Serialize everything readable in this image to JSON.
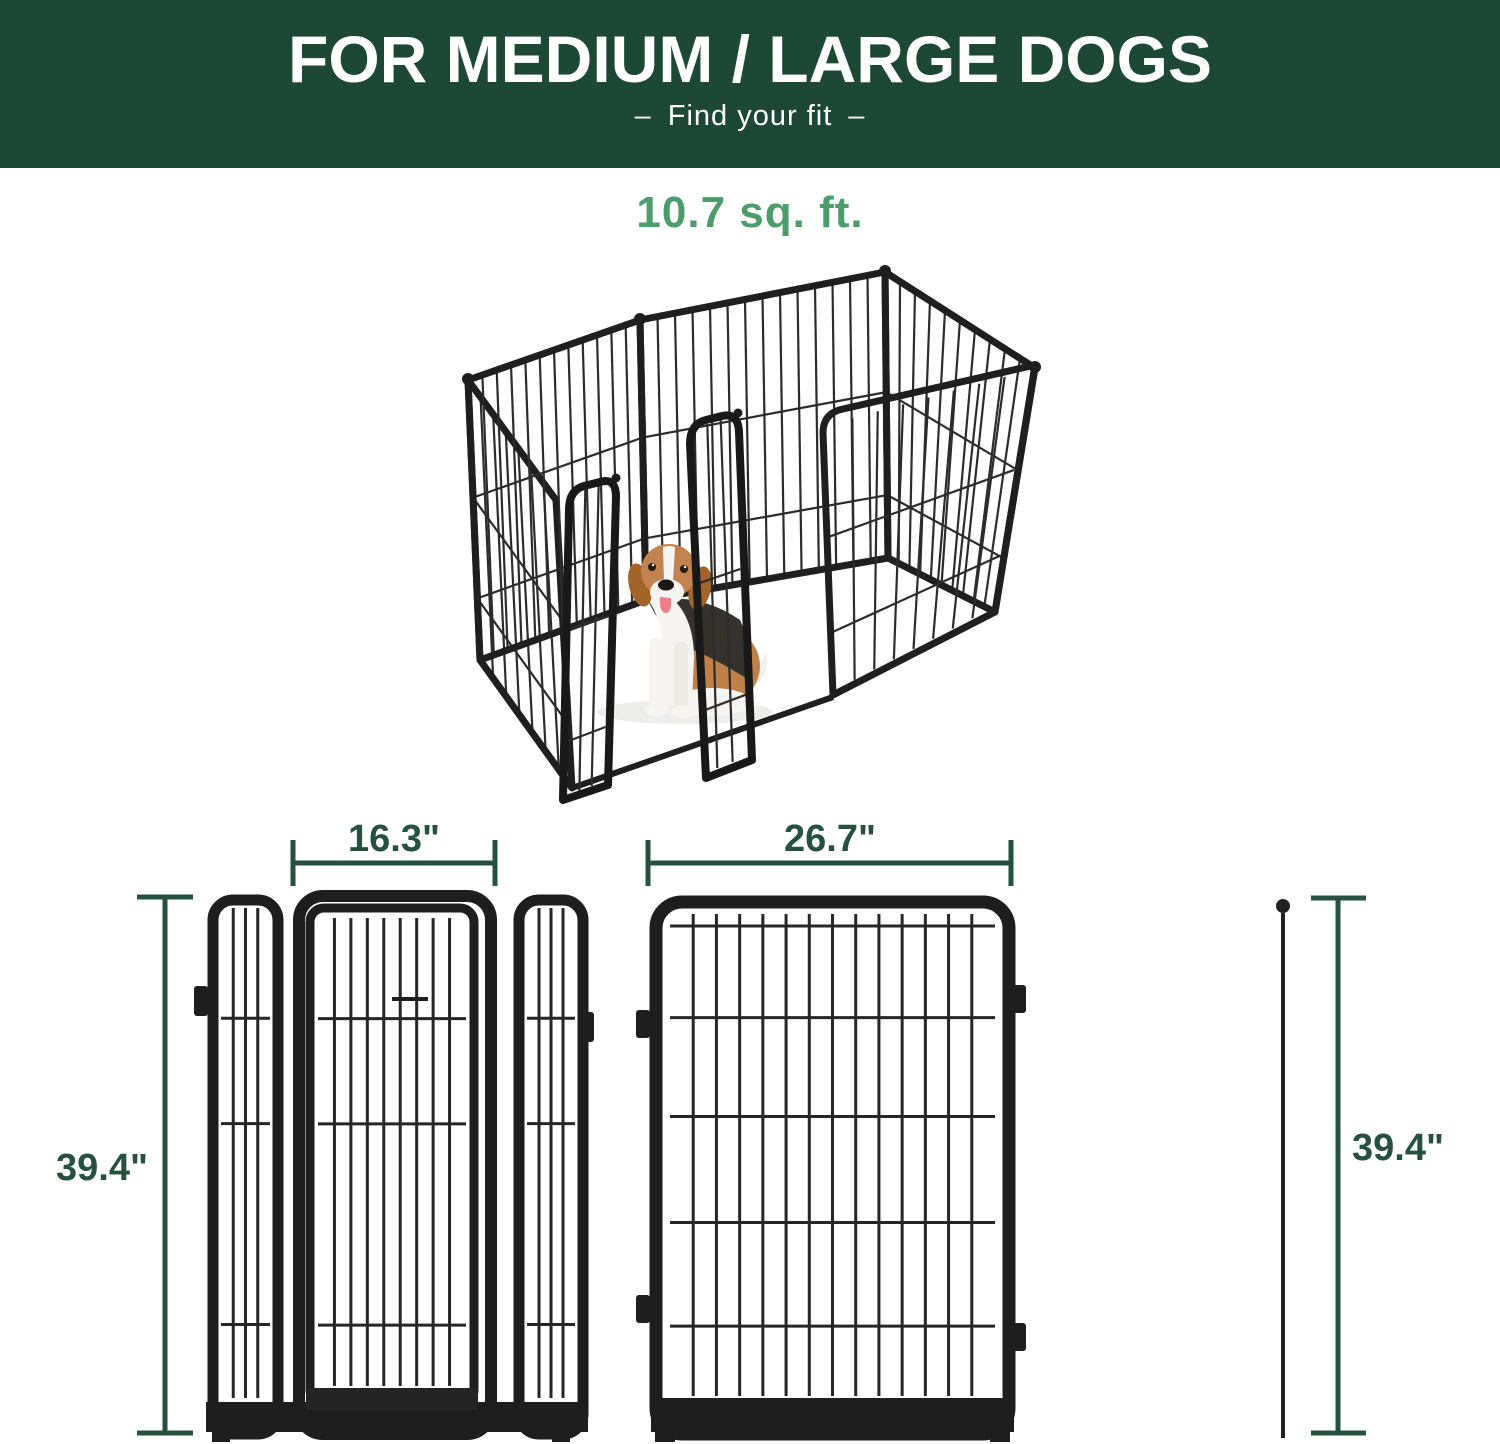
{
  "header": {
    "title": "FOR MEDIUM / LARGE DOGS",
    "subtitle": "Find your fit",
    "dash": "–"
  },
  "hero": {
    "area_label": "10.7 sq. ft.",
    "subject": "metal dog playpen with open double door and seated beagle"
  },
  "dimensions": {
    "door_section_width": "16.3\"",
    "panel_width": "26.7\"",
    "height_left": "39.4\"",
    "height_right": "39.4\""
  },
  "colors": {
    "header_background": "#1e4836",
    "header_text": "#ffffff",
    "accent_green": "#4d9c6c",
    "dimension_green": "#27513f",
    "pen_metal": "#1e1e1e"
  }
}
